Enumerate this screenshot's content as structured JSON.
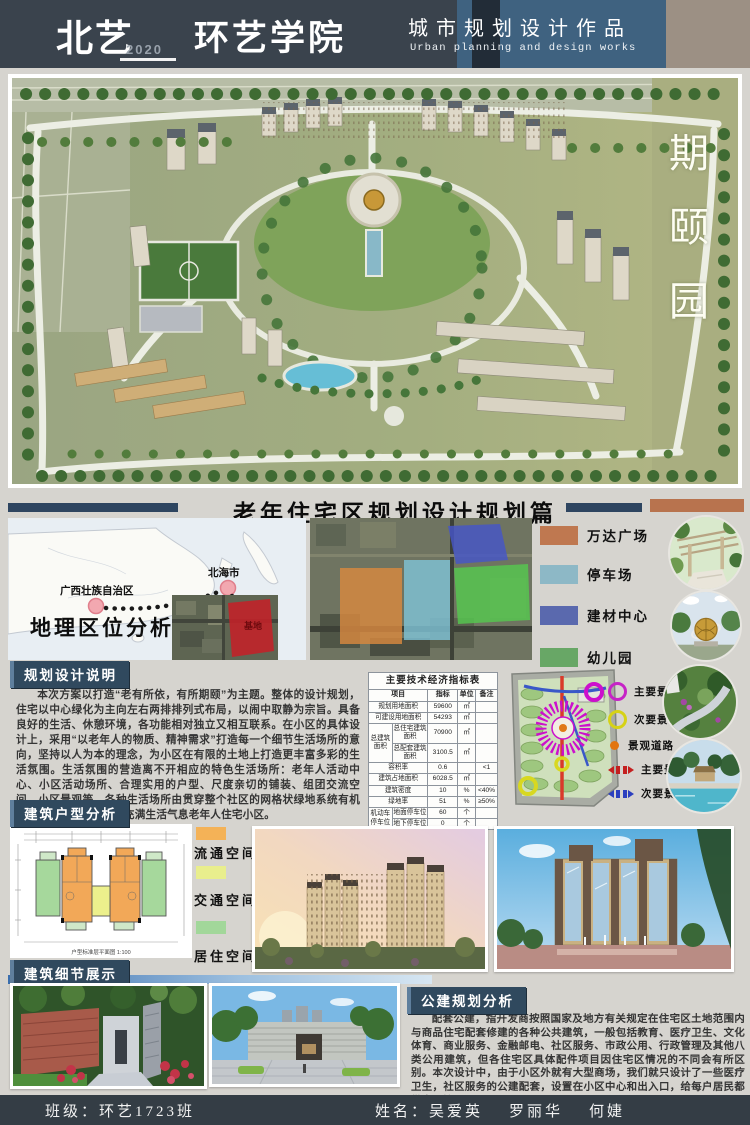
{
  "header": {
    "logo": "北艺",
    "year": "2020",
    "school": "环艺学院",
    "title_cn": "城市规划设计作品",
    "title_en": "Urban planning and design works"
  },
  "hero": {
    "watermark": "期颐园"
  },
  "page_title": "老年住宅区规划设计规划篇",
  "geo": {
    "title": "地理区位分析",
    "province": "广西壮族自治区",
    "city": "北海市",
    "site": "基地"
  },
  "land_legend": {
    "items": [
      {
        "label": "万达广场",
        "color": "#bf7850"
      },
      {
        "label": "停车场",
        "color": "#8db8c6"
      },
      {
        "label": "建材中心",
        "color": "#5a69ae"
      },
      {
        "label": "幼儿园",
        "color": "#68a766"
      }
    ]
  },
  "planning": {
    "header": "规划设计说明",
    "body": "本次方案以打造“老有所依，有所期颐”为主题。整体的设计规划，住宅以中心绿化为主向左右两排排列式布局，以闹中取静为宗旨。具备良好的生活、休憩环境，各功能相对独立又相互联系。在小区的具体设计上，采用“以老年人的物质、精神需求”打造每一个细节生活场所的意向，坚持以人为本的理念，为小区在有限的土地上打造更丰富多彩的生活氛围。生活氛围的营造离不开相应的特色生活场所：老年人活动中心、小区活动场所、合理实用的户型、尺度亲切的铺装、组团交流空间、小区景观等。各种生活场所由贯穿整个社区的网格状绿地系统有机的联系起来，成为一个充满生活气息老年人住宅小区。"
  },
  "indicators": {
    "title": "主要技术经济指标表",
    "columns": [
      "项目",
      "指标",
      "单位",
      "备注"
    ],
    "rows": [
      {
        "item": "规划用地面积",
        "value": "59600",
        "unit": "㎡",
        "note": ""
      },
      {
        "item": "可建设用地面积",
        "value": "54293",
        "unit": "㎡",
        "note": ""
      },
      {
        "group": "总建筑面积",
        "sub": [
          {
            "item": "总住宅建筑面积",
            "value": "70900",
            "unit": "㎡",
            "note": ""
          },
          {
            "item": "总配套建筑面积",
            "value": "3100.5",
            "unit": "㎡",
            "note": ""
          }
        ]
      },
      {
        "item": "容积率",
        "value": "0.6",
        "unit": "",
        "note": "<1"
      },
      {
        "item": "建筑占地面积",
        "value": "6028.5",
        "unit": "㎡",
        "note": ""
      },
      {
        "item": "建筑密度",
        "value": "10",
        "unit": "%",
        "note": "<40%"
      },
      {
        "item": "绿地率",
        "value": "51",
        "unit": "%",
        "note": "≥50%"
      },
      {
        "group": "机动车停车位",
        "sub": [
          {
            "item": "地面停车位",
            "value": "60",
            "unit": "个",
            "note": ""
          },
          {
            "item": "地下停车位",
            "value": "0",
            "unit": "个",
            "note": ""
          }
        ]
      }
    ]
  },
  "siteplan_legend": {
    "items": [
      {
        "label": "主要景观",
        "color": "#c623c6",
        "type": "ring"
      },
      {
        "label": "次要景观",
        "color": "#d6d216",
        "type": "ring"
      },
      {
        "label": "景观道路",
        "color": "#e2750f",
        "type": "dot"
      },
      {
        "label": "主要景观轴线",
        "color": "#c42020",
        "type": "axis"
      },
      {
        "label": "次要景观轴线",
        "color": "#2b3fbf",
        "type": "axis"
      }
    ]
  },
  "unit": {
    "header": "建筑户型分析",
    "caption": "户型标准层平面图 1:100",
    "legend": [
      {
        "label": "流通空间",
        "color": "#f4b257"
      },
      {
        "label": "交通空间",
        "color": "#e9ee8d"
      },
      {
        "label": "居住空间",
        "color": "#a2d79a"
      }
    ]
  },
  "detail": {
    "header": "建筑细节展示"
  },
  "public": {
    "header": "公建规划分析",
    "body": "配套公建，指开发商按照国家及地方有关规定在住宅区土地范围内与商品住宅配套修建的各种公共建筑，一般包括教育、医疗卫生、文化体育、商业服务、金融邮电、社区服务、市政公用、行政管理及其他八类公用建筑，但各住宅区具体配件项目因住宅区情况的不同会有所区别。本次设计中，由于小区外就有大型商场，我们就只设计了一些医疗卫生，社区服务的公建配套，设置在小区中心和出入口，给每户居民都带来便捷性。"
  },
  "footer": {
    "class_label": "班级：环艺1723班",
    "name_prefix": "姓名：",
    "names": [
      "吴爱英",
      "罗丽华",
      "何婕"
    ]
  },
  "colors": {
    "header_dark": "#3a434d",
    "header_blue": "#3f6280",
    "header_tan": "#9c9084",
    "navy_bar": "#2e4560",
    "title_bar_orange": "#b8734e",
    "footer": "#343d45"
  }
}
